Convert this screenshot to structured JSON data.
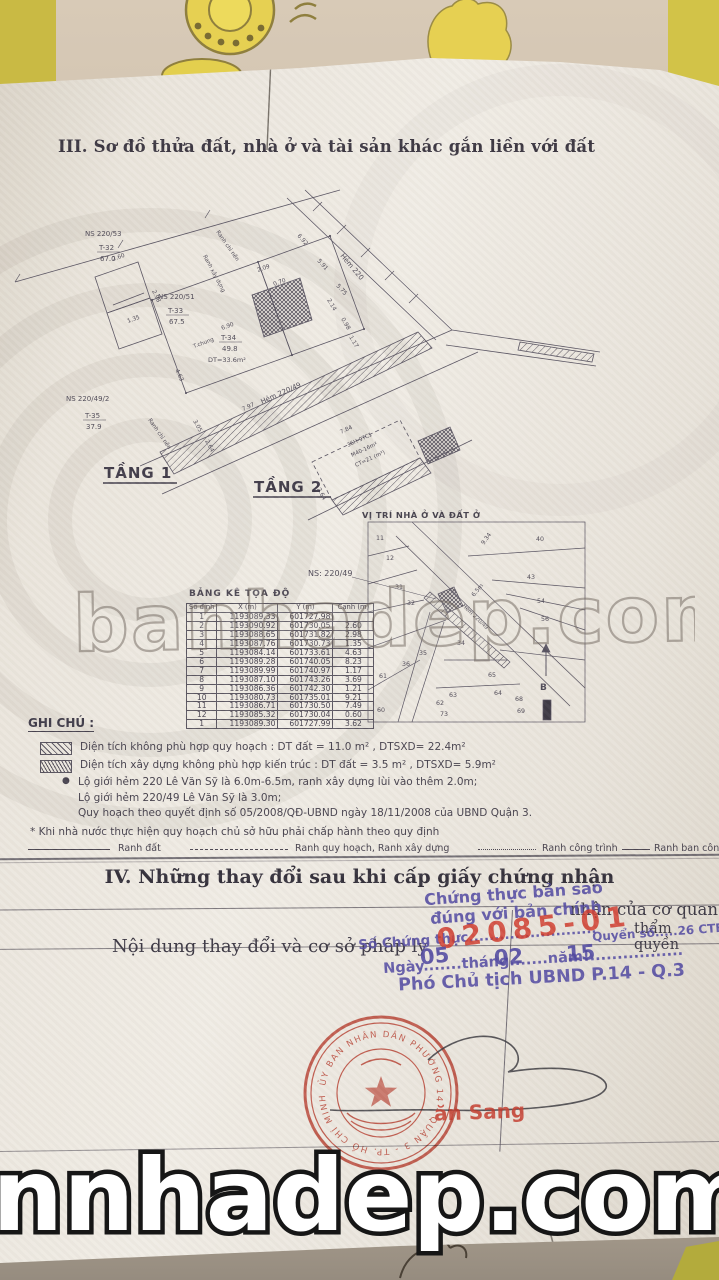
{
  "colors": {
    "paper": "#ece7df",
    "fabric_yellow": "#cdbf4a",
    "ink": "#575260",
    "seal_red": "#c23a2b",
    "stamp_blue": "#564ea4",
    "number_red": "#d0392b"
  },
  "page": {
    "section3_title": "III. Sơ đồ thửa đất, nhà ở và tài sản khác gắn liền với đất",
    "section4_title": "IV. Những thay đổi sau khi cấp giấy chứng nhận",
    "col1_header": "Nội dung thay đổi và cơ sở pháp lý",
    "col2_frag1": "nhận của cơ quan",
    "col2_frag2": "thẩm quyền"
  },
  "diagram": {
    "floor1": "TẦNG 1",
    "floor2": "TẦNG 2",
    "vitri_title": "VỊ TRÍ NHÀ Ở VÀ ĐẤT Ở",
    "p32": {
      "ns": "NS 220/53",
      "num": "T-32",
      "area": "67.0"
    },
    "p33": {
      "ns": "NS 220/51",
      "num": "T-33",
      "area": "67.5"
    },
    "p34": {
      "num": "T-34",
      "area": "49.8",
      "dt": "DT=33.6m²"
    },
    "p35": {
      "ns": "NS 220/49/2",
      "num": "T-35",
      "area": "37.9"
    },
    "ns_label": "NS: 220/49",
    "alley1": "Hẻm 220/49",
    "alley2": "Hẻm 220",
    "edge_label1": "Ranh chỉ nền",
    "edge_label2": "Ranh xây dựng",
    "shared_wall": "T.chung",
    "tang2_lines": [
      "36H-9TC1",
      "M40-16m²",
      "CT=21 (m²)"
    ],
    "dims": [
      "2.60",
      "2.98",
      "1.35",
      "4.63",
      "6.90",
      "2.09",
      "0.70",
      "2.14",
      "0.98",
      "1.17",
      "7.97",
      "3.05",
      "2.64",
      "6.92",
      "5.91",
      "5.75",
      "7.84",
      "2.64"
    ],
    "map": {
      "parcels": [
        "11",
        "12",
        "31",
        "32",
        "34",
        "35",
        "36",
        "61",
        "60",
        "62",
        "63",
        "73",
        "64",
        "65",
        "68",
        "69",
        "40",
        "43",
        "54",
        "56"
      ],
      "dim1": "9.34",
      "dim2": "6.5m",
      "alley": "Hẻm 220/49",
      "north": "B"
    }
  },
  "coord_table": {
    "title": "BẢNG KÊ TỌA ĐỘ",
    "headers": [
      "Số đỉnh",
      "X (m)",
      "Y (m)",
      "Cạnh (m)"
    ],
    "rows": [
      [
        "1",
        "1193089.33",
        "601727.98",
        ""
      ],
      [
        "2",
        "1193090.92",
        "601730.05",
        "2.60"
      ],
      [
        "3",
        "1193088.65",
        "601731.82",
        "2.98"
      ],
      [
        "4",
        "1193087.76",
        "601730.73",
        "1.35"
      ],
      [
        "5",
        "1193084.14",
        "601733.61",
        "4.63"
      ],
      [
        "6",
        "1193089.28",
        "601740.05",
        "8.23"
      ],
      [
        "7",
        "1193089.99",
        "601740.97",
        "1.17"
      ],
      [
        "8",
        "1193087.10",
        "601743.26",
        "3.69"
      ],
      [
        "9",
        "1193086.36",
        "601742.30",
        "1.21"
      ],
      [
        "10",
        "1193080.73",
        "601735.01",
        "9.21"
      ],
      [
        "11",
        "1193086.71",
        "601730.50",
        "7.49"
      ],
      [
        "12",
        "1193085.32",
        "601730.04",
        "0.60"
      ],
      [
        "1",
        "1193089.30",
        "601727.99",
        "3.62"
      ]
    ]
  },
  "notes": {
    "heading": "GHI CHÚ :",
    "bullet": "●",
    "legend1": "Diện tích không phù hợp quy hoạch : DT đất = 11.0 m² , DTSXD= 22.4m²",
    "legend2": "Diện tích xây dựng không phù hợp kiến trúc : DT đất = 3.5 m² , DTSXD= 5.9m²",
    "b1": "Lộ giới hẻm 220 Lê Văn Sỹ là 6.0m-6.5m, ranh xây dựng lùi vào thêm 2.0m;",
    "b2": "Lộ giới hẻm 220/49 Lê Văn Sỹ là 3.0m;",
    "b3": "Quy hoạch theo quyết định số 05/2008/QĐ-UBND ngày 18/11/2008 của UBND Quận 3.",
    "star": "* Khi nhà nước thực hiện quy hoạch chủ sở hữu phải chấp hành theo quy định",
    "lg1": "Ranh đất",
    "lg2": "Ranh quy hoạch, Ranh xây dựng",
    "lg3": "Ranh công trình",
    "lg4": "Ranh ban công"
  },
  "certify": {
    "l1": "Chứng thực bản sao",
    "l2": "đúng với bản chính",
    "so_label": "Số Chứng thực.........................",
    "so_value": "02085-01",
    "quyen": "Quyển số.....26 CTBS",
    "date_line": "Ngày.......tháng.......năm!.................",
    "day": "05",
    "month": "02",
    "year": "15",
    "title": "Phó Chủ tịch UBND P.14 - Q.3",
    "signer": "ăn Sang",
    "seal_text": "ỦY BAN NHÂN DÂN PHƯỜNG 14 - QUẬN 3 - TP. HỒ CHÍ MINH"
  },
  "watermarks": {
    "center": "banhadep.com",
    "bottom": "nnhadep.com"
  }
}
